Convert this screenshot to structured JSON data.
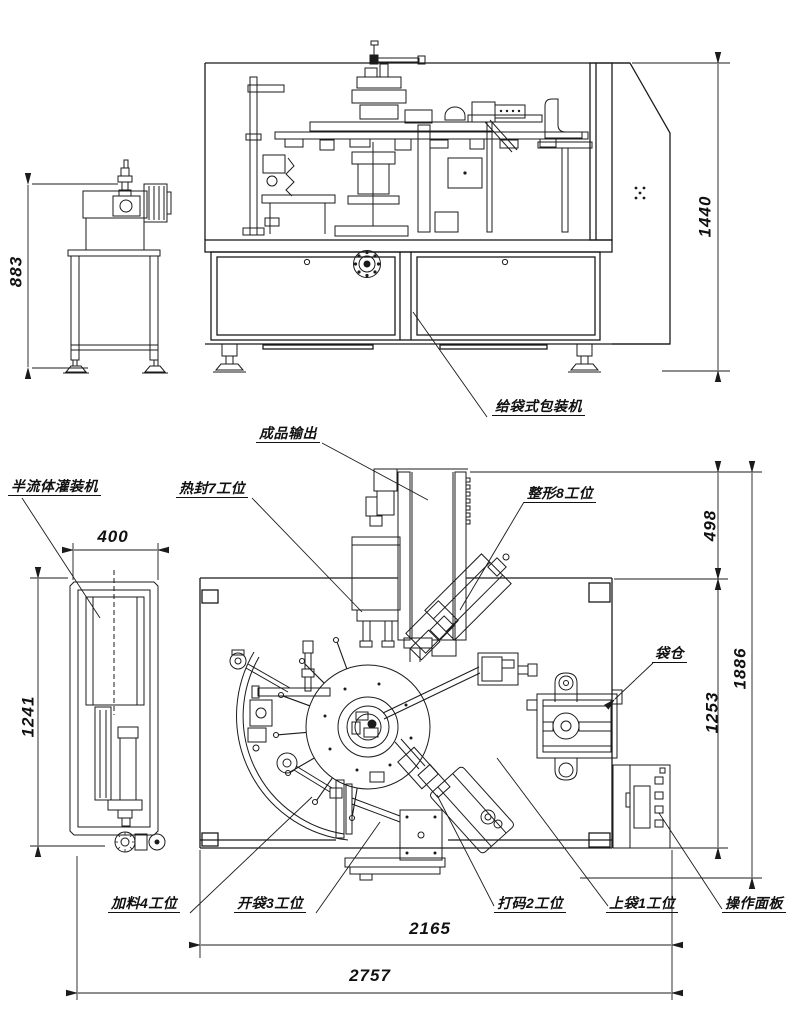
{
  "front_view": {
    "machine_label": "给袋式包装机",
    "dims": {
      "main_height": "1440",
      "filler_height": "883"
    }
  },
  "plan_view": {
    "labels": {
      "finished_output": "成品输出",
      "filler_machine": "半流体灌装机",
      "heat_seal_7": "热封7工位",
      "shaping_8": "整形8工位",
      "bag_magazine": "袋仓",
      "feeding_4": "加料4工位",
      "bag_open_3": "开袋3工位",
      "coding_2": "打码2工位",
      "bag_load_1": "上袋1工位",
      "control_panel": "操作面板"
    },
    "dims": {
      "filler_width": "400",
      "filler_length": "1241",
      "output_offset": "498",
      "body_length": "1253",
      "overall_depth": "1886",
      "inner_span": "2165",
      "overall_span": "2757"
    }
  },
  "line_color": "#1b1b1b"
}
